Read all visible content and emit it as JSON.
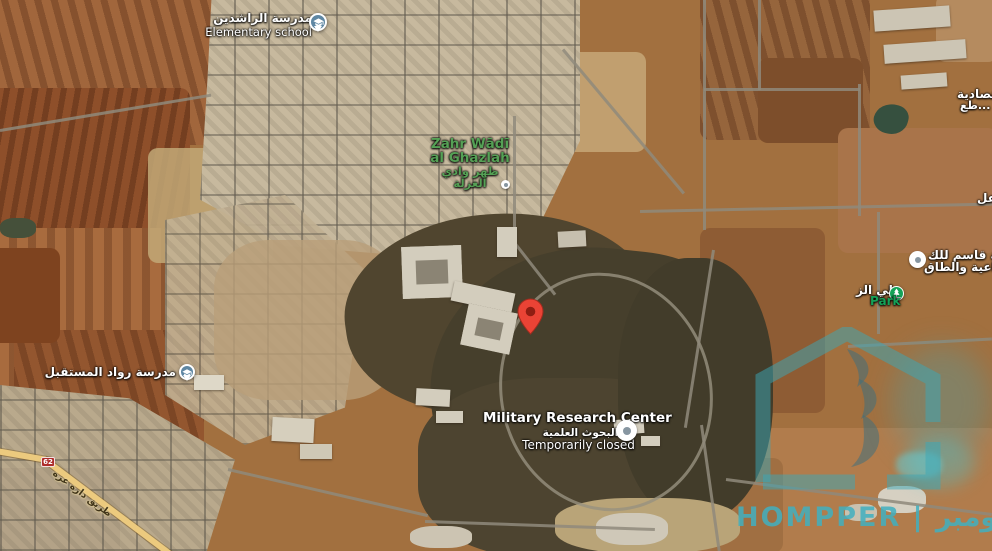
{
  "labels": {
    "school_rashideen": {
      "name_ar": "مدرسة الراشدين",
      "type_en": "Elementary school"
    },
    "locality": {
      "en_line1": "Zahr Wādī",
      "en_line2": "al Ghazlah",
      "ar_line1": "ظهر وادي",
      "ar_line2": "الغزلة"
    },
    "military_center": {
      "name_en": "Military Research Center",
      "name_ar": "البحوث العلمية",
      "status": "Temporarily closed"
    },
    "company": {
      "line1": "شركة قاسم للك",
      "line2": "الصناعية والطاق"
    },
    "park": {
      "name_ar": "علي الز",
      "label_en": "Park"
    },
    "school_future": {
      "name_ar": "مدرسة رواد المستقبل"
    },
    "economic_area": {
      "line1": "قتصادية",
      "line2": "طع..."
    },
    "edge_fragment": "عل",
    "road": {
      "shield": "62",
      "name_ar": "طريق داره عزه"
    }
  },
  "watermark": {
    "text": "HOMPPER | هومبر"
  },
  "colors": {
    "pin_red": "#ea4335",
    "locality_green": "#55a055",
    "park_green": "#14a257",
    "school_blue": "#5f87a3",
    "watermark_teal": "#41b0c0",
    "highway_yellow": "#ecca7e",
    "shield_red": "#ae2d2b"
  }
}
